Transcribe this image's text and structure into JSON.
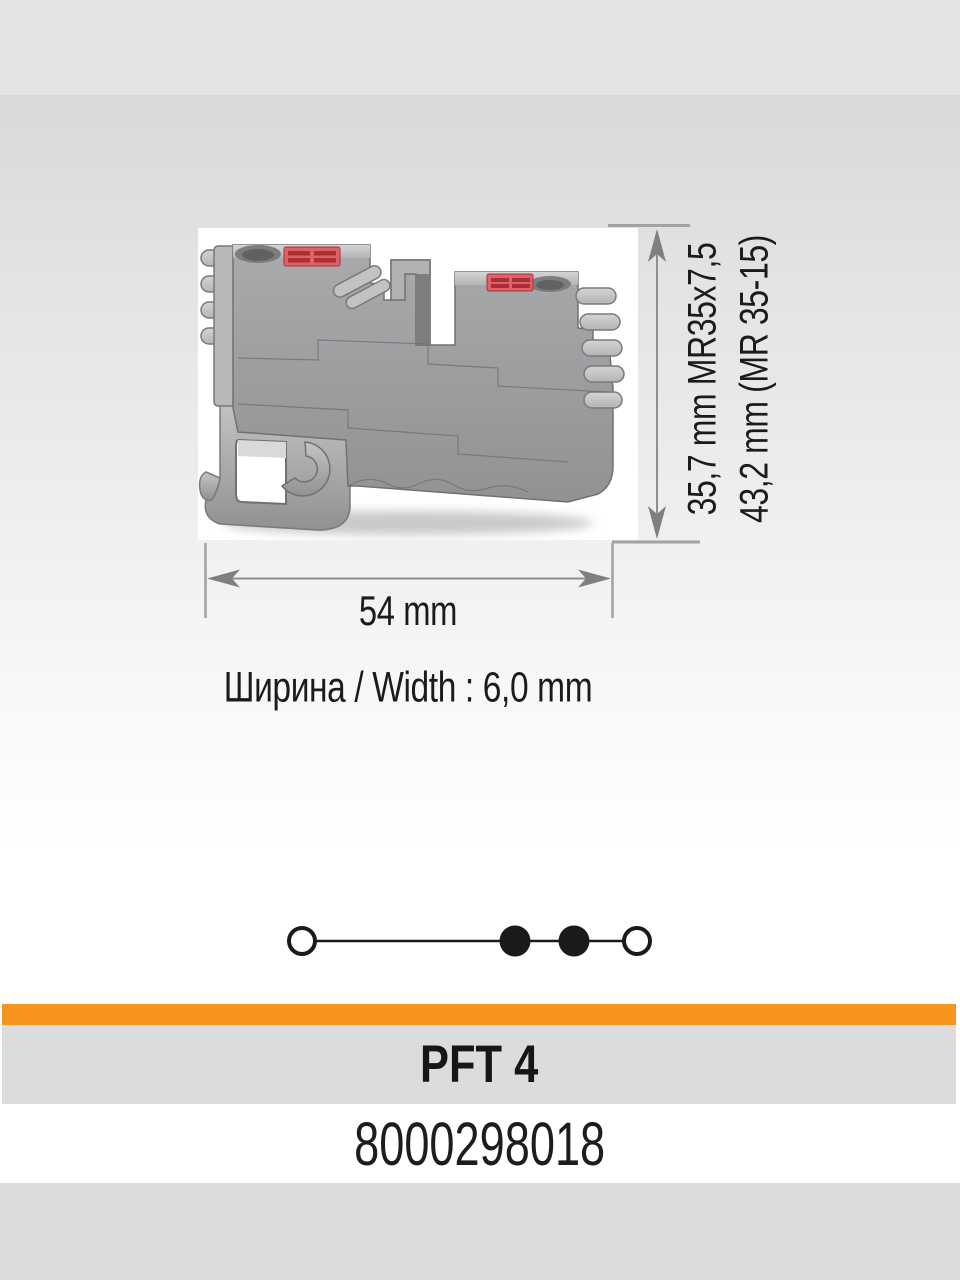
{
  "product": {
    "name": "PFT 4",
    "code": "8000298018"
  },
  "dimensions": {
    "height_primary": "35,7 mm MR35x7,5",
    "height_secondary": "43,2 mm (MR 35-15)",
    "width_total": "54 mm",
    "width_note": "Ширина / Width : 6,0 mm"
  },
  "diagram": {
    "type": "feed-through terminal circuit symbol",
    "terminals": [
      "open-circle",
      "filled-circle",
      "filled-circle",
      "open-circle"
    ]
  },
  "colors": {
    "accent-orange": "#f7941d",
    "band-gray": "#dcdcdc",
    "dim-line": "#8f8f8f",
    "clamp-red": "#d9595e",
    "body-gray": "#a6a8aa"
  }
}
